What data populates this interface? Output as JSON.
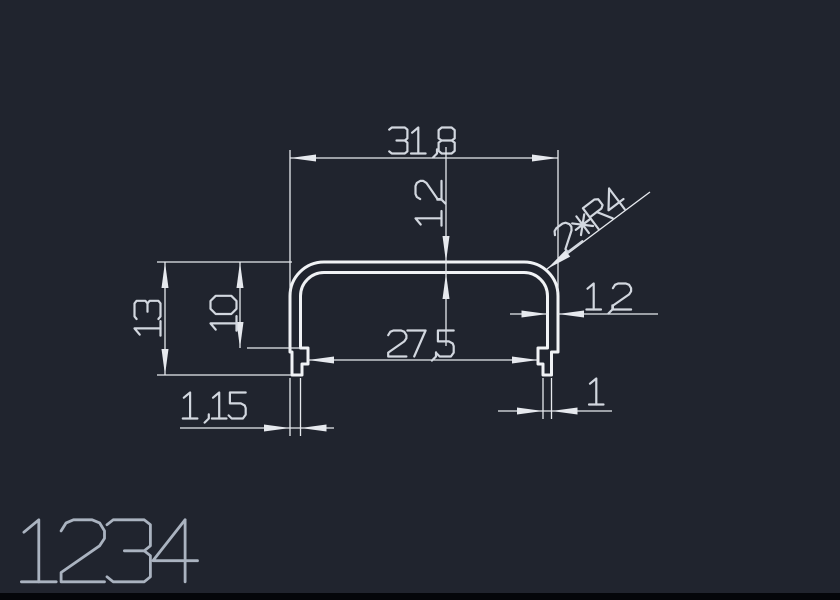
{
  "drawing": {
    "type": "profile-cross-section",
    "part_label": "1234",
    "dimensions": {
      "top_width": "31,8",
      "top_thickness": "1,2",
      "corner_radius": "2*R4",
      "right_wall_thickness": "1,2",
      "overall_height": "13",
      "inner_depth": "10",
      "inner_width": "27,5",
      "left_tip_width": "1,15",
      "right_tip_width": "1"
    }
  },
  "colors": {
    "background": "#20242e",
    "line": "#f0f2f5",
    "dim_line": "#e6e9ee",
    "dim_text": "#d2d7df",
    "part_label": "#aab3c0",
    "bottom_bar": "#04060a"
  }
}
